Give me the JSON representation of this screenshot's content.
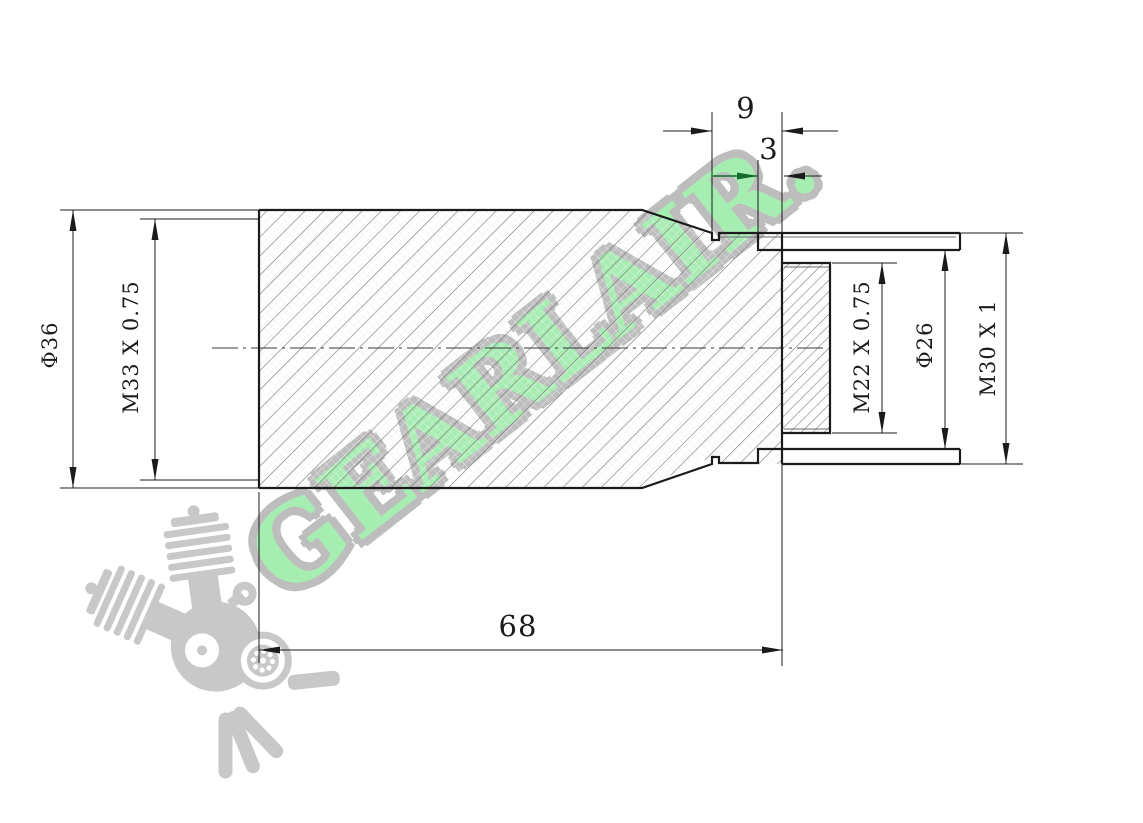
{
  "watermark": {
    "brand": "GEARLAIR."
  },
  "drawing": {
    "labels": {
      "left_outer_diameter": "Φ36",
      "left_thread": "M33 X 0.75",
      "top_length": "9",
      "top_groove_width": "3",
      "stub_thread": "M22 X 0.75",
      "bore_diameter": "Φ26",
      "right_thread": "M30 X 1",
      "overall_length": "68"
    },
    "colors": {
      "outline": "#1b1b1b",
      "hatch": "#757575",
      "green_arrow": "#156a2e",
      "watermark_green": "#a6edb2",
      "watermark_outline": "#bdbdbd",
      "logo_gray": "#c8c8c8"
    }
  }
}
